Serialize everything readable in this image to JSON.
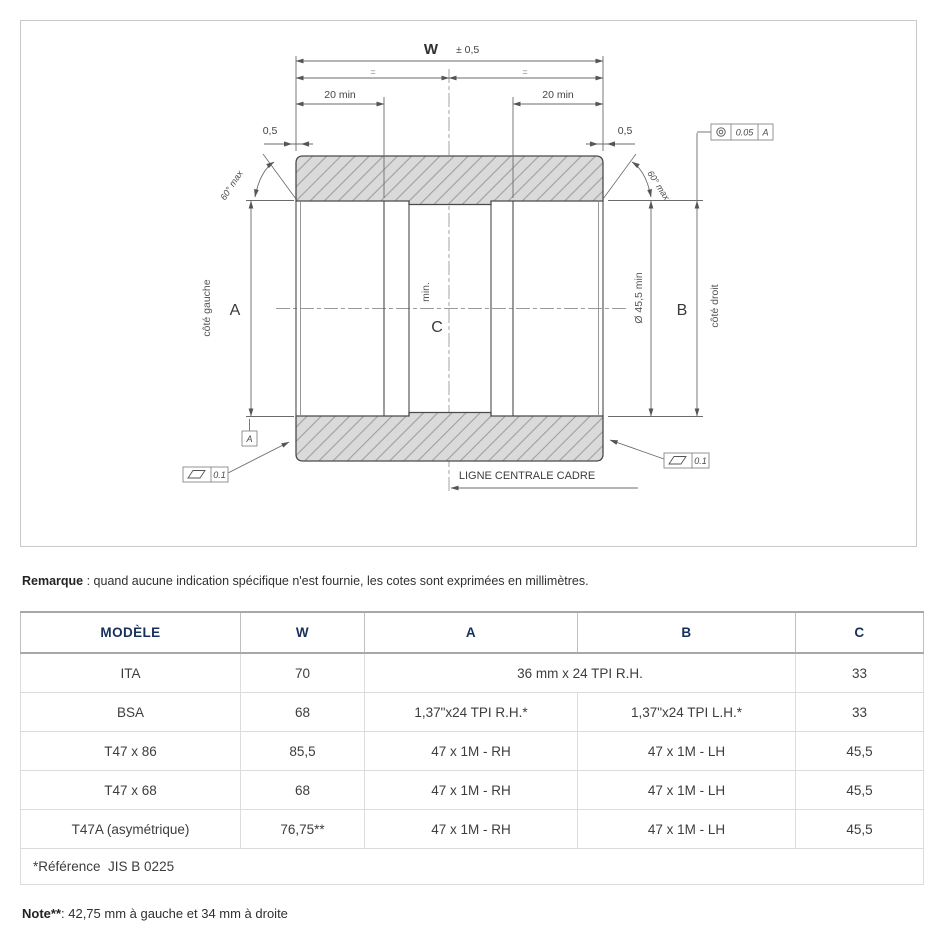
{
  "colors": {
    "header_text": "#16325c",
    "hatch_fill": "#dadada",
    "part_line": "#4a4a4a",
    "dim_line": "#6b6b6b"
  },
  "drawing": {
    "dim_w": "W",
    "dim_w_tol": "± 0,5",
    "equal_mark": "=",
    "dim_20min_left": "20 min",
    "dim_20min_right": "20 min",
    "dim_05_left": "0,5",
    "dim_05_right": "0,5",
    "angle_left": "60° max",
    "angle_right": "60° max",
    "label_a": "A",
    "label_b": "B",
    "label_c": "C",
    "label_c_min": "min.",
    "side_left": "côté gauche",
    "side_right": "côté droit",
    "dia_min": "Ø 45,5 min",
    "centerline_label": "LIGNE CENTRALE CADRE",
    "datum_label": "A",
    "tol_runout": {
      "value": "0.05",
      "datum": "A"
    },
    "tol_flat_left": "0.1",
    "tol_flat_right": "0.1"
  },
  "remark": {
    "label": "Remarque",
    "text": " : quand aucune indication spécifique n'est fournie, les cotes sont exprimées en millimètres."
  },
  "table": {
    "headers": [
      "MODÈLE",
      "W",
      "A",
      "B",
      "C"
    ],
    "rows": [
      {
        "model": "ITA",
        "w": "70",
        "ab_merged": "36 mm x 24 TPI R.H.",
        "c": "33"
      },
      {
        "model": "BSA",
        "w": "68",
        "a": "1,37\"x24 TPI R.H.*",
        "b": "1,37\"x24 TPI L.H.*",
        "c": "33"
      },
      {
        "model": "T47 x 86",
        "w": "85,5",
        "a": "47 x 1M - RH",
        "b": "47 x 1M - LH",
        "c": "45,5"
      },
      {
        "model": "T47 x 68",
        "w": "68",
        "a": "47 x 1M - RH",
        "b": "47 x 1M - LH",
        "c": "45,5"
      },
      {
        "model": "T47A (asymétrique)",
        "w": "76,75**",
        "a": "47 x 1M - RH",
        "b": "47 x 1M - LH",
        "c": "45,5"
      }
    ],
    "footer": "*Référence  JIS B 0225"
  },
  "note": {
    "label": "Note**",
    "text": ": 42,75 mm à gauche et 34 mm à droite"
  }
}
